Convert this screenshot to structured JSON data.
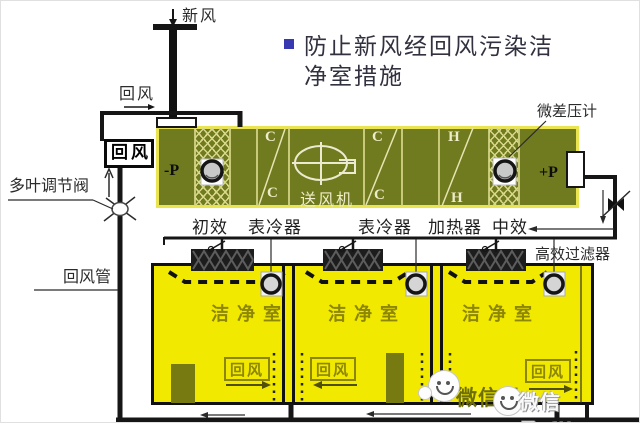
{
  "title": {
    "line1": "防止新风经回风污染洁",
    "line2": "净室措施"
  },
  "labels": {
    "fresh_air": "新风",
    "return_air_top": "回风",
    "return_air_inlet": "回风",
    "damper_valve": "多叶调节阀",
    "return_duct": "回风管",
    "diff_pressure_gauge": "微差压计",
    "hepa_filter": "高效过滤器",
    "minus_p": "-P",
    "plus_p": "+P",
    "cooler_letter": "C",
    "heater_letter": "H",
    "fan": "送风机",
    "pre_filter": "初效",
    "cooler1": "表冷器",
    "cooler2": "表冷器",
    "heater": "加热器",
    "mid_filter": "中效"
  },
  "rooms": [
    {
      "name": "洁净室",
      "return_label": "回风"
    },
    {
      "name": "洁净室",
      "return_label": "回风"
    },
    {
      "name": "洁净室",
      "return_label": "回风"
    }
  ],
  "watermark": {
    "back_text": "微信号",
    "front_text": "微信号:filter"
  },
  "colors": {
    "ahu_body": "#707a1e",
    "ahu_border": "#e9e44f",
    "ahu_lines": "#d8d88a",
    "room_fill": "#f2e900",
    "room_text": "#8c8600",
    "title_bullet": "#3838b0",
    "pipe": "#161616"
  }
}
